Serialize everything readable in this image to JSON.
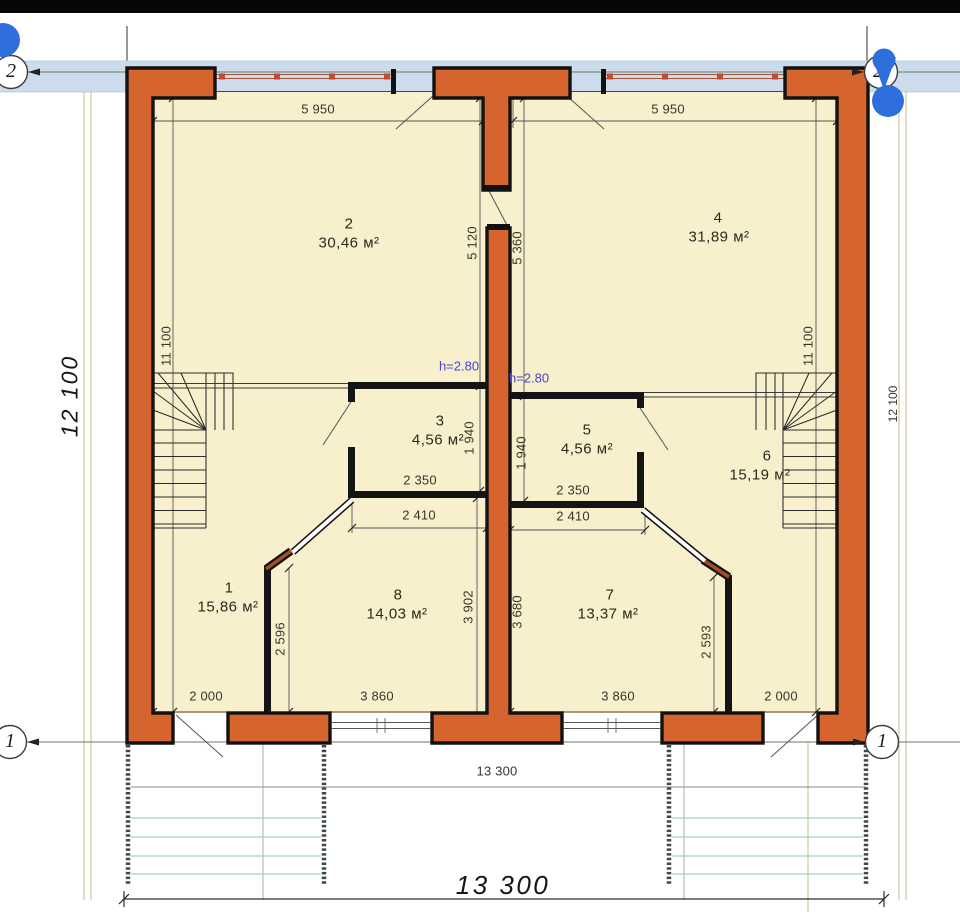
{
  "plan": {
    "grid_axes": {
      "top_left": "2",
      "top_right": "2",
      "bottom_left": "1",
      "bottom_right": "1"
    },
    "rooms": {
      "r1": {
        "num": "1",
        "area": "15,86 м²"
      },
      "r2": {
        "num": "2",
        "area": "30,46 м²"
      },
      "r3": {
        "num": "3",
        "area": "4,56 м²"
      },
      "r4": {
        "num": "4",
        "area": "31,89 м²"
      },
      "r5": {
        "num": "5",
        "area": "4,56 м²"
      },
      "r6": {
        "num": "6",
        "area": "15,19 м²"
      },
      "r7": {
        "num": "7",
        "area": "13,37 м²"
      },
      "r8": {
        "num": "8",
        "area": "14,03 м²"
      }
    },
    "height_notes": {
      "left": "h=2.80",
      "right": "h=2.80"
    },
    "dims": {
      "top_left": "5 950",
      "top_right": "5 950",
      "left_overall": "12 100",
      "right_overall": "12 100",
      "left_inner": "11 100",
      "right_inner": "11 100",
      "center_left": "5 120",
      "center_right": "5 360",
      "wc_left_width": "2 350",
      "wc_left_clear": "2 410",
      "wc_right_width": "2 350",
      "wc_right_clear": "2 410",
      "wc_left_depth": "1 940",
      "wc_right_depth": "1 940",
      "hall_left": "2 596",
      "hall_right": "2 593",
      "room8_depth": "3 902",
      "room7_depth": "3 680",
      "bottom_left_door": "2 000",
      "bottom_left_window": "3 860",
      "bottom_right_window": "3 860",
      "bottom_right_door": "2 000",
      "bottom_inner": "13 300",
      "bottom_overall": "13 300"
    },
    "colors": {
      "wall": "#d5642e",
      "room_fill": "#f8efcc",
      "glazing_band": "#cddcec",
      "terrace_lines": "#9ed3c8",
      "marker_blue": "#2f6fdd",
      "note_blue": "#4646cf"
    }
  }
}
